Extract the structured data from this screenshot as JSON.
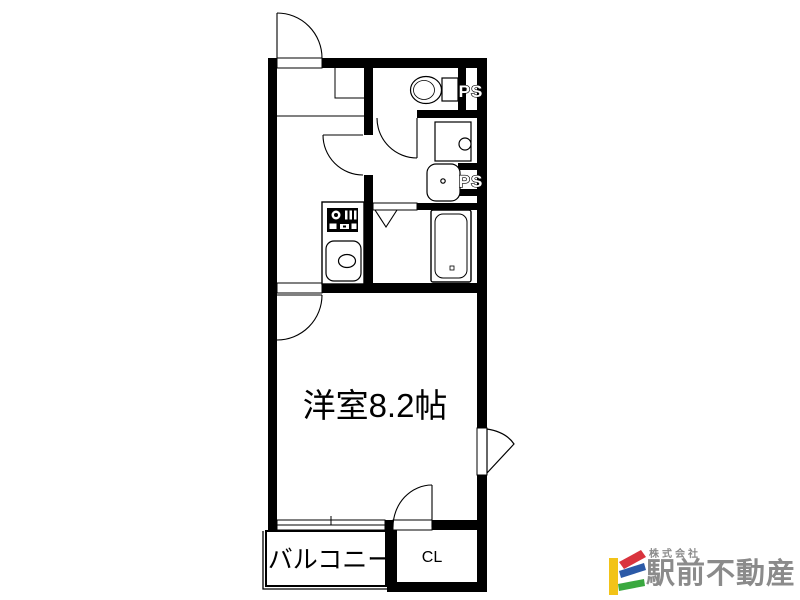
{
  "floorplan": {
    "labels": {
      "main_room": "洋室8.2帖",
      "balcony": "バルコニー",
      "closet": "CL",
      "pipe_space_1": "PS",
      "pipe_space_2": "PS"
    },
    "line_color": "#000000",
    "background": "#ffffff"
  },
  "logo": {
    "company_prefix": "株式会社",
    "company_name": "駅前不動産",
    "colors": {
      "gray": "#8b8b8b",
      "yellow": "#f2c318",
      "red": "#d9333d",
      "blue": "#2b59a7",
      "green": "#3aa83f"
    }
  }
}
